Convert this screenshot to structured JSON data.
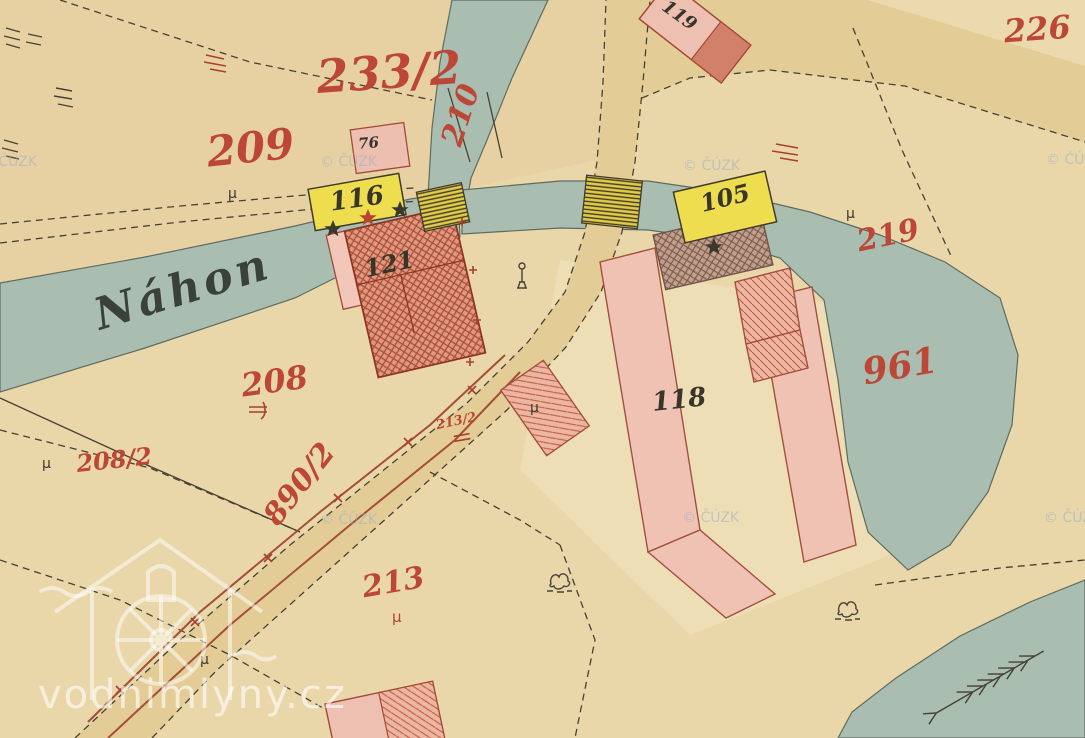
{
  "map_type": "historical cadastral map sheet (hand-coloured)",
  "palette": {
    "paper": "#e9d6a9",
    "road": "#e4cc97",
    "water": "#a9beb1",
    "building_pink": "#efc0b2",
    "building_red_hatched": "#dd9a80",
    "building_yellow": "#eedd4e",
    "building_brown_hatched": "#c39e8c",
    "parcel_number_red": "#bd4736",
    "ink": "#38352a",
    "copyright_watermark_blue": "#9cb2c8"
  },
  "watercourse": {
    "name": "Náhon"
  },
  "parcels": [
    {
      "number": "233/2"
    },
    {
      "number": "209"
    },
    {
      "number": "210"
    },
    {
      "number": "208"
    },
    {
      "number": "208/2"
    },
    {
      "number": "890/2"
    },
    {
      "number": "213"
    },
    {
      "number": "213/2"
    },
    {
      "number": "219"
    },
    {
      "number": "961"
    },
    {
      "number": "226"
    }
  ],
  "buildings": [
    {
      "number": "119"
    },
    {
      "number": "76"
    },
    {
      "number": "116"
    },
    {
      "number": "121"
    },
    {
      "number": "105"
    },
    {
      "number": "118"
    }
  ],
  "watermarks": {
    "site": "vodnimlyny.cz",
    "copyright": "© ČÚZK"
  },
  "symbols": {
    "meadow_mark": "µ",
    "star_marker": "five-point star",
    "bush": "shrub sketch",
    "flow_arrow": "feather arrow",
    "monument": "wayside column",
    "bridge": "hatched yellow footbridge"
  }
}
